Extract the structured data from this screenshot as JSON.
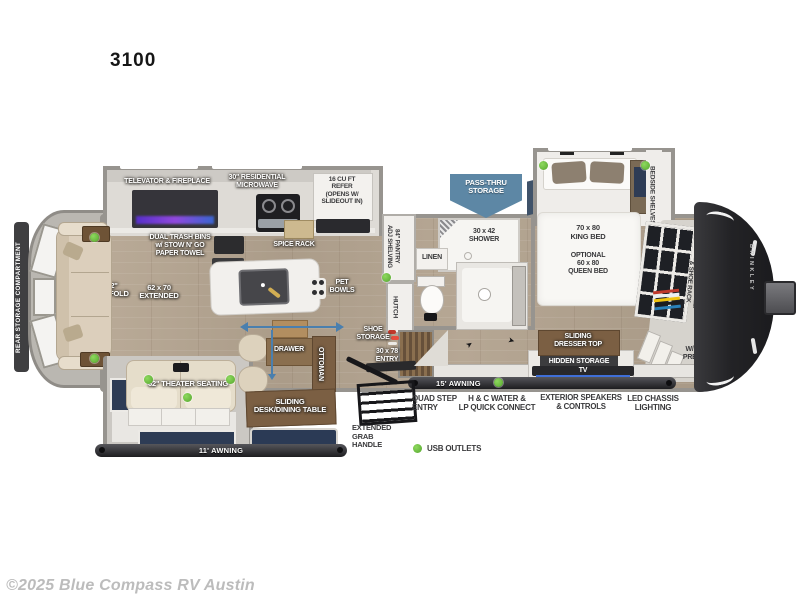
{
  "title": "3100",
  "copyright": "©2025 Blue Compass RV Austin",
  "brand_on_cap": "BRINKLEY",
  "colors": {
    "accent_blue": "#5d87a5",
    "usb_green": "#5cb832",
    "window_navy": "#2e3c55",
    "wall_gray": "#97948f",
    "wood_label_brown": "#7b5f43",
    "dark_bar": "#2a2a2c"
  },
  "legend": {
    "usb_outlets": "USB OUTLETS"
  },
  "labels": {
    "rear_storage_compartment": "REAR STORAGE COMPARTMENT",
    "televator_fireplace": "TELEVATOR & FIREPLACE",
    "residential_microwave": "30\" RESIDENTIAL\nMICROWAVE",
    "refer": "16 CU FT\nREFER\n(OPENS W/\nSLIDEOUT IN)",
    "pass_thru_storage": "PASS-THRU\nSTORAGE",
    "dual_trash_bins": "DUAL TRASH BINS\nw/ STOW N' GO\nPAPER TOWEL",
    "spice_rack": "SPICE RACK",
    "pantry": "84\" PANTRY\nADJ SHELVING",
    "hutch": "HUTCH",
    "linen": "LINEN",
    "shower": "30 x 42\nSHOWER",
    "tri_fold_sofa": "72\"\nTRI-FOLD",
    "sofa_extended": "62 x 70\nEXTENDED",
    "pet_bowls": "PET\nBOWLS",
    "theater_seating": "62\" THEATER SEATING",
    "drawer": "DRAWER",
    "ottoman": "OTTOMAN",
    "sliding_desk": "SLIDING\nDESK/DINING TABLE",
    "shoe_storage": "SHOE\nSTORAGE",
    "entry_door": "30 x 78\nENTRY",
    "awning_11": "11' AWNING",
    "awning_15": "15' AWNING",
    "extended_grab_handle": "EXTENDED\nGRAB\nHANDLE",
    "king_bed": "70 x 80\nKING BED",
    "queen_bed_option": "OPTIONAL\n60 x 80\nQUEEN BED",
    "bedside_shelves": "BEDSIDE SHELVES",
    "wardrobe": "WARDROBE SHELF\n& SHOE RACK",
    "sliding_dresser_top": "SLIDING\nDRESSER TOP",
    "hidden_storage": "HIDDEN STORAGE",
    "tv": "TV",
    "wd_prep": "W/D\nPREP"
  },
  "features": {
    "quad_step_entry": "QUAD STEP\nENTRY",
    "hc_water_lp": "H & C WATER &\nLP QUICK CONNECT",
    "exterior_speakers": "EXTERIOR SPEAKERS\n& CONTROLS",
    "led_chassis_lighting": "LED CHASSIS\nLIGHTING"
  }
}
